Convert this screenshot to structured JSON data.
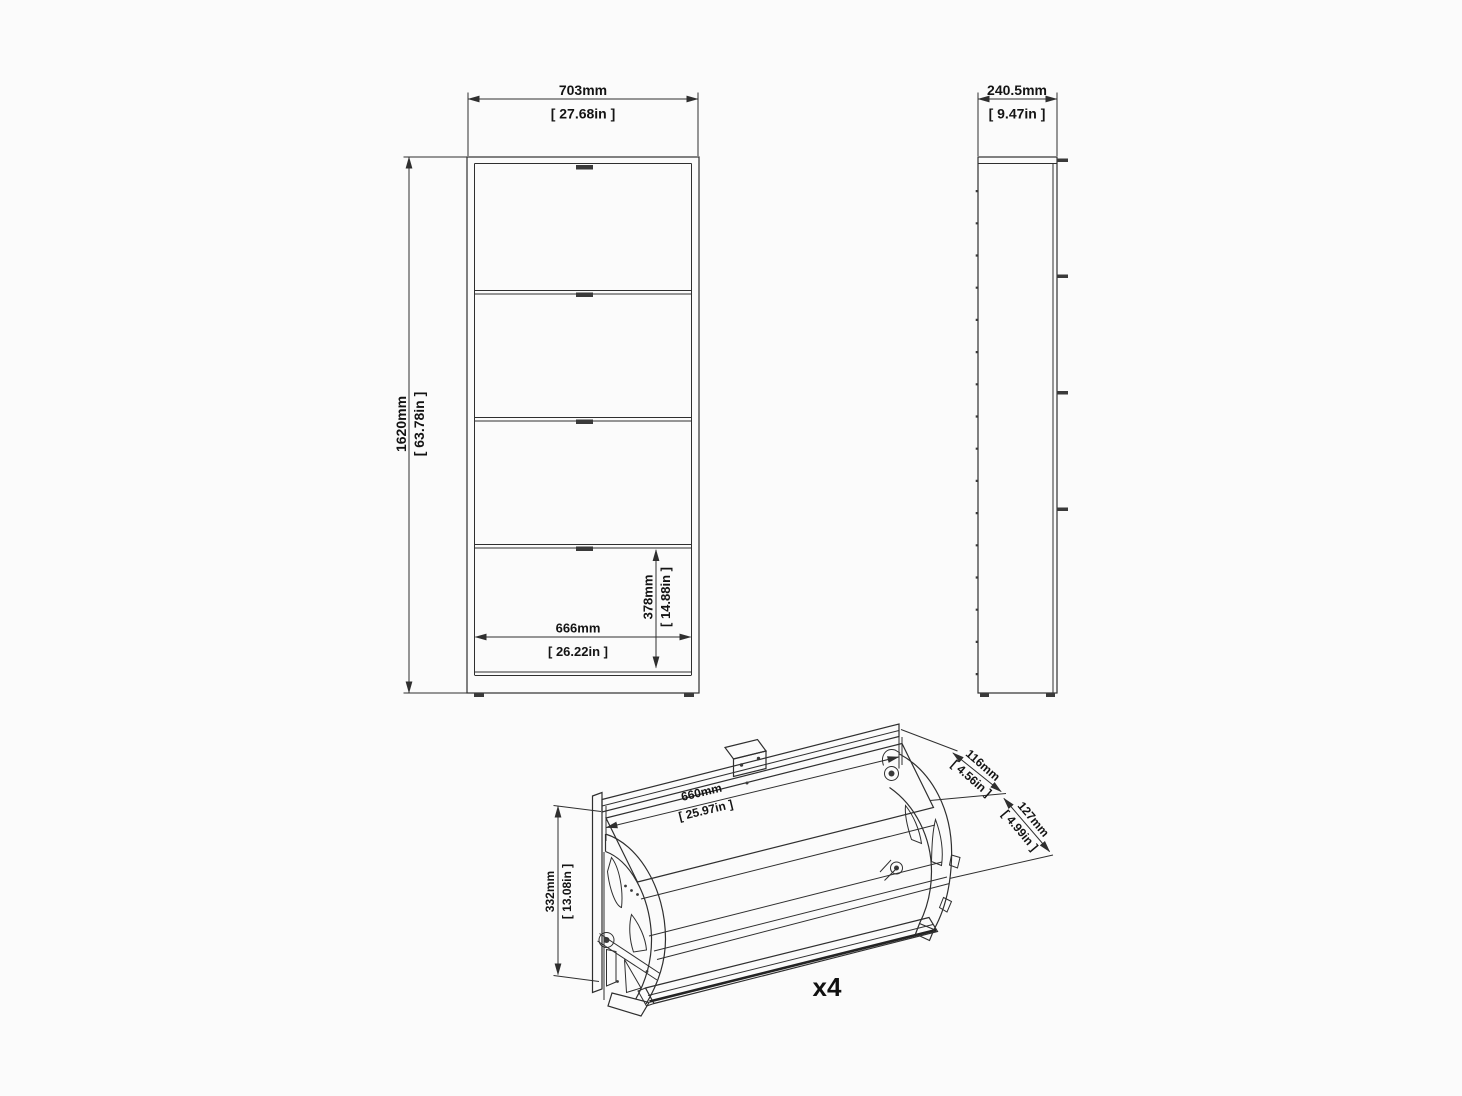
{
  "views": {
    "front": {
      "width": {
        "mm": "703mm",
        "inch": "[ 27.68in ]"
      },
      "height": {
        "mm": "1620mm",
        "inch": "[ 63.78in ]"
      },
      "inner_width": {
        "mm": "666mm",
        "inch": "[ 26.22in ]"
      },
      "compartment_height": {
        "mm": "378mm",
        "inch": "[ 14.88in ]"
      }
    },
    "side": {
      "depth": {
        "mm": "240.5mm",
        "inch": "[ 9.47in ]"
      }
    },
    "drawer_unit": {
      "width": {
        "mm": "660mm",
        "inch": "[ 25.97in ]"
      },
      "height": {
        "mm": "332mm",
        "inch": "[ 13.08in ]"
      },
      "upper_depth": {
        "mm": "116mm",
        "inch": "[ 4.56in ]"
      },
      "lower_depth": {
        "mm": "127mm",
        "inch": "[ 4.99in ]"
      },
      "quantity": "x4"
    }
  },
  "colors": {
    "line": "#2f2f2f",
    "text": "#141414",
    "background": "#fbfbfb"
  }
}
